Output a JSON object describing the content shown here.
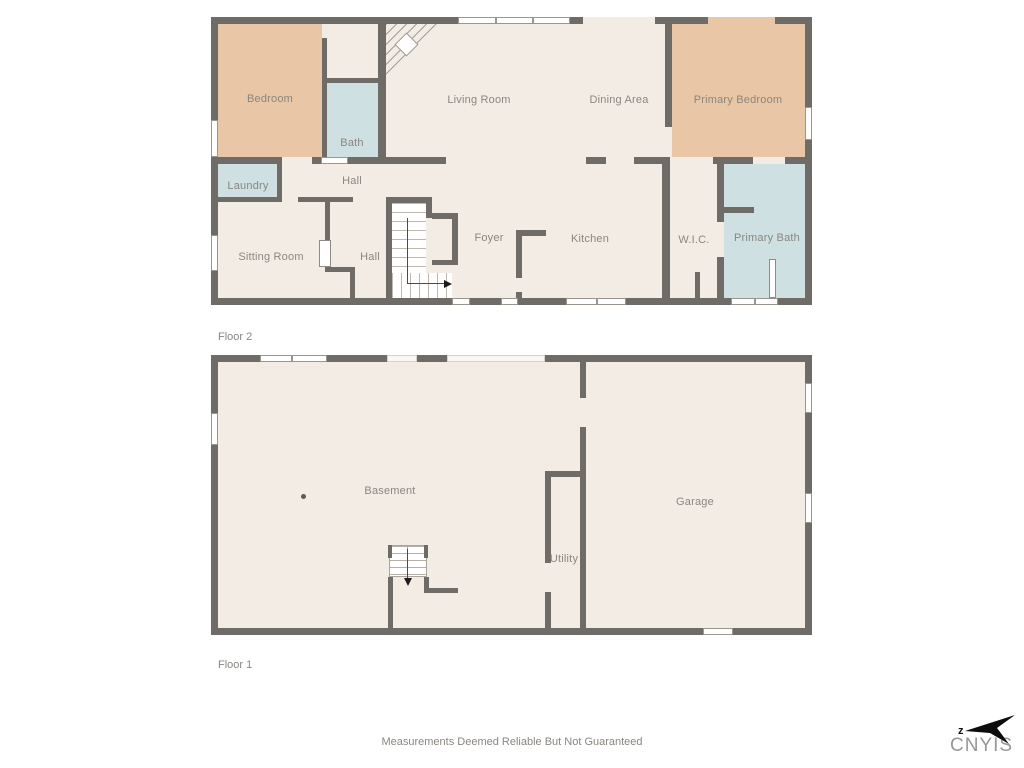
{
  "colors": {
    "wall": "#6f6b67",
    "floor": "#f2ece5",
    "bedroom_fill": "#e9c6a5",
    "bath_fill": "#cfe0e2",
    "label_text": "#8a8680"
  },
  "floor2": {
    "tag": "Floor 2",
    "rooms": [
      {
        "label": "Bedroom"
      },
      {
        "label": "Bath"
      },
      {
        "label": "Living Room"
      },
      {
        "label": "Dining Area"
      },
      {
        "label": "Primary Bedroom"
      },
      {
        "label": "Laundry"
      },
      {
        "label": "Hall"
      },
      {
        "label": "Sitting Room"
      },
      {
        "label": "Hall"
      },
      {
        "label": "Foyer"
      },
      {
        "label": "Kitchen"
      },
      {
        "label": "W.I.C."
      },
      {
        "label": "Primary Bath"
      }
    ]
  },
  "floor1": {
    "tag": "Floor 1",
    "rooms": [
      {
        "label": "Basement"
      },
      {
        "label": "Utility"
      },
      {
        "label": "Garage"
      }
    ]
  },
  "footer": {
    "disclaimer": "Measurements Deemed Reliable But Not Guaranteed"
  },
  "logo": {
    "text": "CNYIS",
    "north_marker": "z"
  },
  "icons": {
    "north_arrow": "north-arrow-icon",
    "stairs_up_arrow": "stair-direction-arrow-right",
    "stairs_down_arrow": "stair-direction-arrow-down"
  }
}
